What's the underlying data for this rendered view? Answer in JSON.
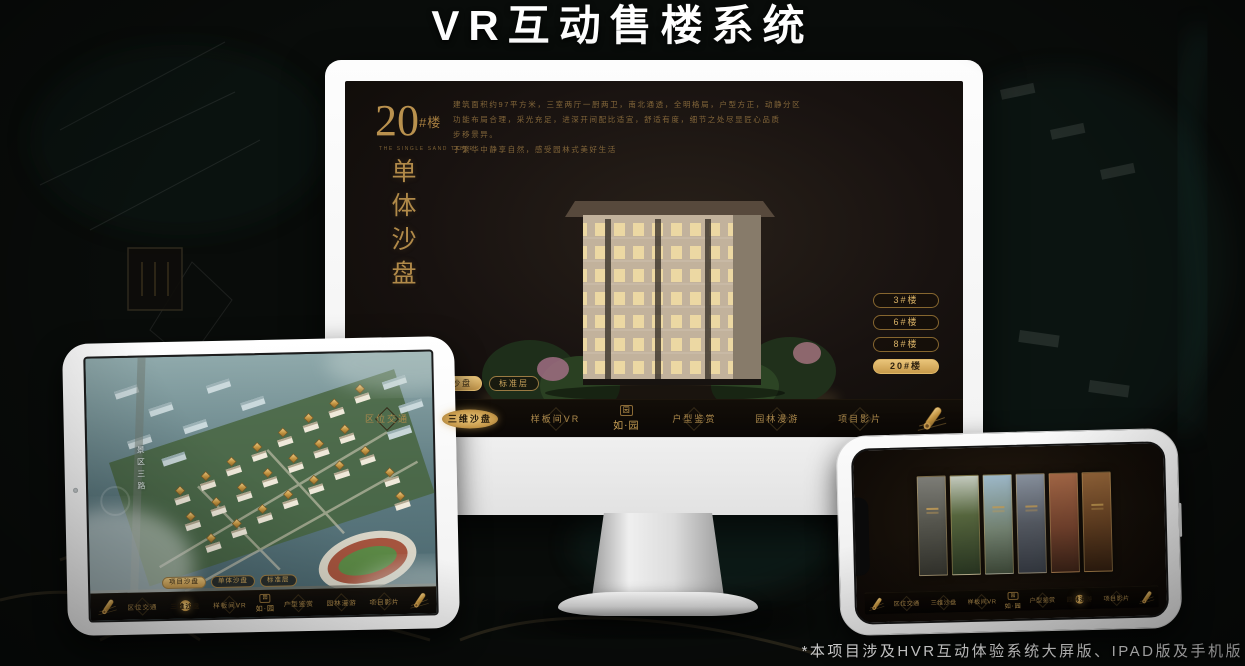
{
  "page": {
    "title": "VR互动售楼系统",
    "footnote": "*本项目涉及HVR互动体验系统大屏版、IPAD版及手机版"
  },
  "colors": {
    "gold_accent": "#c79a4b",
    "gold_bright": "#eac77c",
    "gold_text": "#ad8a4c",
    "screen_background": "#181210",
    "navbar_background": "#0a0705",
    "title_text": "#ffffff"
  },
  "nav": {
    "items": [
      "区位交通",
      "三维沙盘",
      "样板间VR",
      "户型鉴赏",
      "园林漫游",
      "项目影片"
    ],
    "logo_mark": "园",
    "logo_text": "如·园"
  },
  "sub_tabs": {
    "items": [
      "项目沙盘",
      "单体沙盘",
      "标准层"
    ]
  },
  "monitor": {
    "panel": {
      "number": "20",
      "suffix": "#楼",
      "english": "THE SINGLE SAND TABLE",
      "vertical_title": "单体沙盘"
    },
    "description_lines": [
      "建筑面积约97平方米，三室两厅一厨两卫，南北通透，全明格局，户型方正，动静分区",
      "功能布局合理，采光充足，进深开间配比适宜，舒适有度，细节之处尽显匠心品质",
      "步移景异。",
      "于繁华中静享自然，感受园林式美好生活"
    ],
    "building_buttons": [
      "3#楼",
      "6#楼",
      "8#楼",
      "20#楼"
    ]
  },
  "tablet": {
    "road_label": "景区三路"
  }
}
